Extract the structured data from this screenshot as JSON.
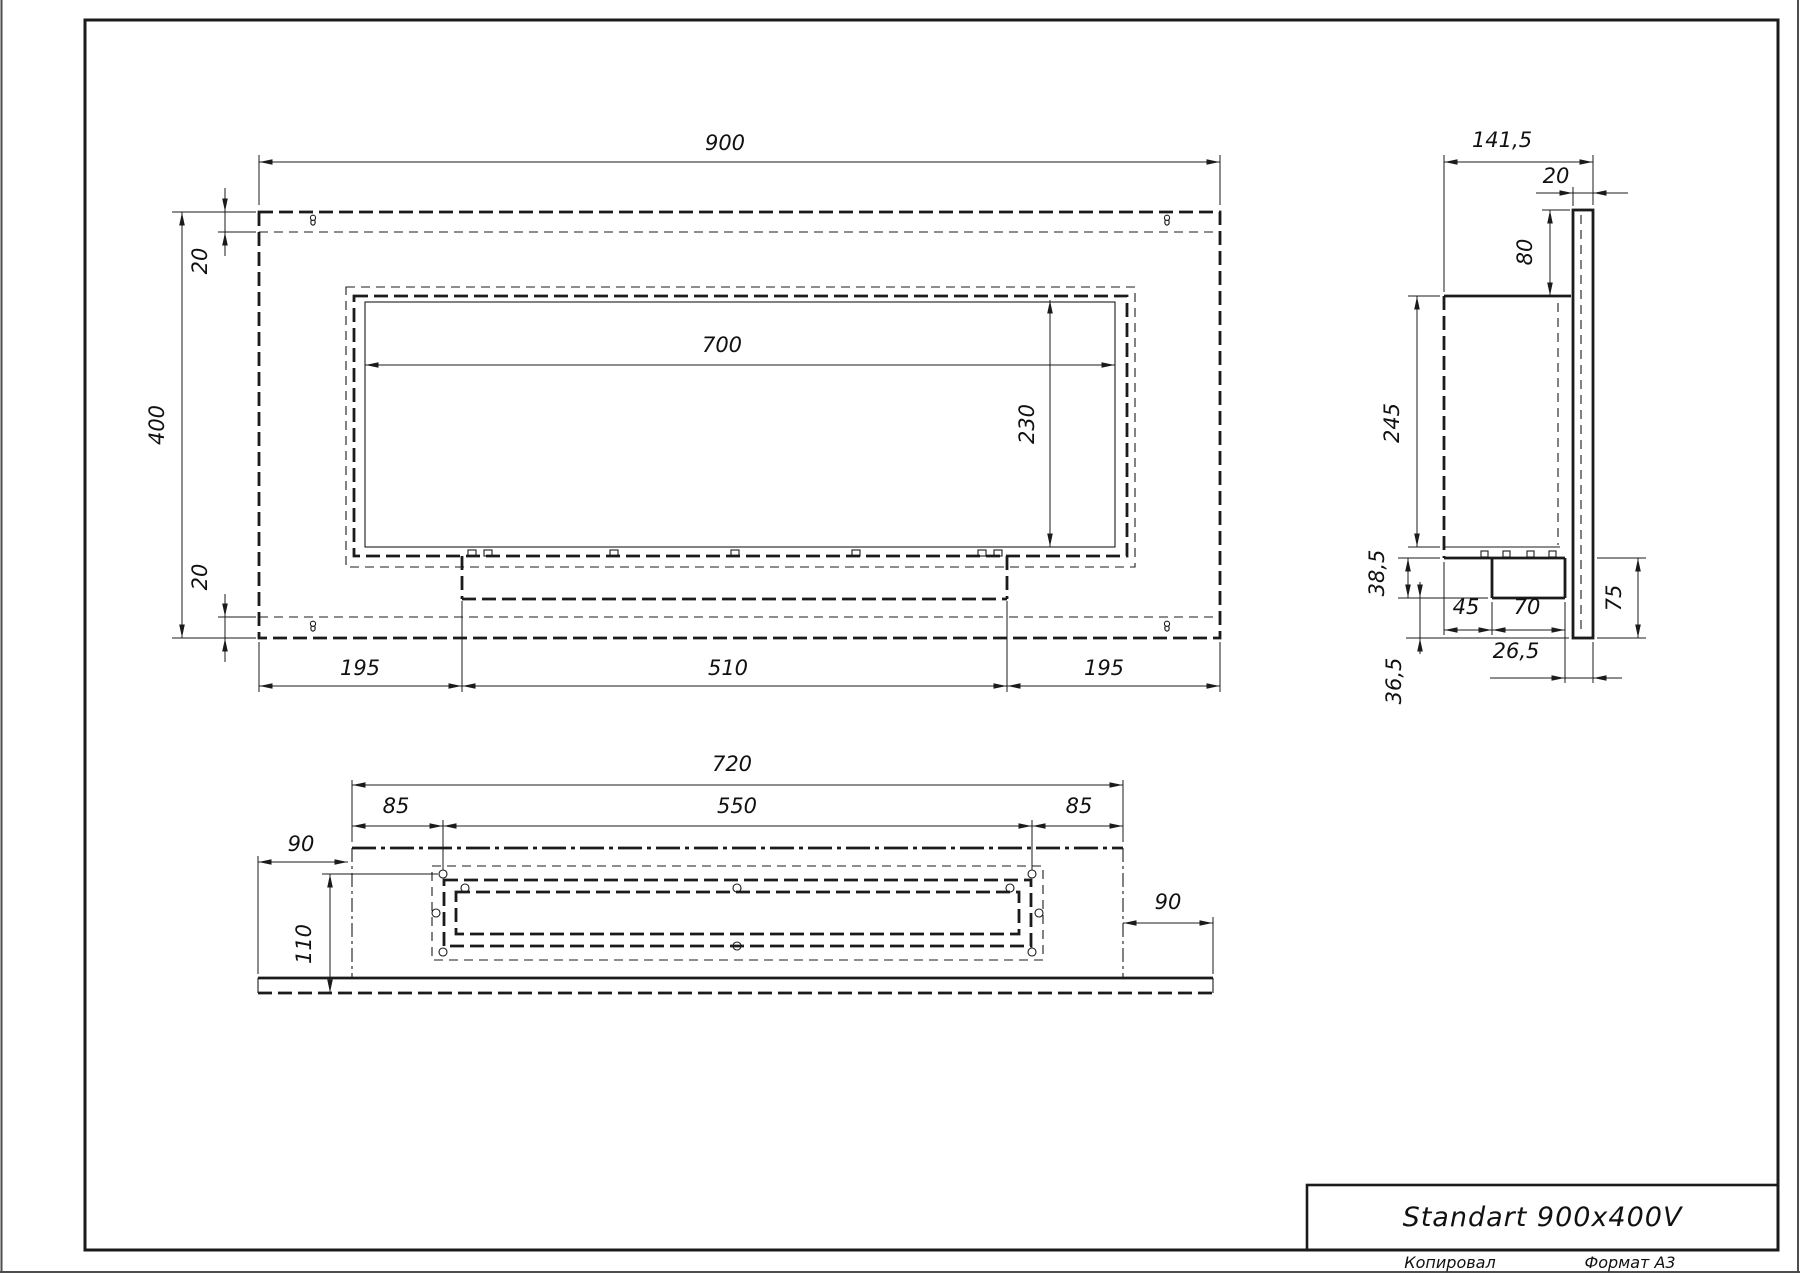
{
  "title_block": {
    "title": "Standart 900x400V",
    "copied_label": "Копировал",
    "format_label": "Формат A3"
  },
  "views": {
    "front": {
      "label": "front-view",
      "dimensions": [
        {
          "id": "front-width-900",
          "text": "900",
          "x": 725,
          "y": 150,
          "rot": 0
        },
        {
          "id": "front-offset-20-top",
          "text": "20",
          "x": 207,
          "y": 261,
          "rot": -90
        },
        {
          "id": "front-height-400",
          "text": "400",
          "x": 164,
          "y": 425,
          "rot": -90
        },
        {
          "id": "front-offset-20-bottom",
          "text": "20",
          "x": 207,
          "y": 577,
          "rot": -90
        },
        {
          "id": "front-window-width-700",
          "text": "700",
          "x": 722,
          "y": 352,
          "rot": 0
        },
        {
          "id": "front-window-height-230",
          "text": "230",
          "x": 1034,
          "y": 424,
          "rot": -90
        },
        {
          "id": "front-left-195",
          "text": "195",
          "x": 360,
          "y": 675,
          "rot": 0
        },
        {
          "id": "front-center-510",
          "text": "510",
          "x": 728,
          "y": 675,
          "rot": 0
        },
        {
          "id": "front-right-195",
          "text": "195",
          "x": 1104,
          "y": 675,
          "rot": 0
        }
      ]
    },
    "side": {
      "label": "side-view",
      "dimensions": [
        {
          "id": "side-depth-141-5",
          "text": "141,5",
          "x": 1502,
          "y": 147,
          "rot": 0
        },
        {
          "id": "side-panel-20",
          "text": "20",
          "x": 1556,
          "y": 183,
          "rot": 0
        },
        {
          "id": "side-top-80",
          "text": "80",
          "x": 1532,
          "y": 252,
          "rot": -90
        },
        {
          "id": "side-body-245",
          "text": "245",
          "x": 1399,
          "y": 423,
          "rot": -90
        },
        {
          "id": "side-38-5",
          "text": "38,5",
          "x": 1384,
          "y": 573,
          "rot": -90
        },
        {
          "id": "side-45",
          "text": "45",
          "x": 1466,
          "y": 614,
          "rot": 0
        },
        {
          "id": "side-70",
          "text": "70",
          "x": 1527,
          "y": 614,
          "rot": 0
        },
        {
          "id": "side-75",
          "text": "75",
          "x": 1621,
          "y": 598,
          "rot": -90
        },
        {
          "id": "side-26-5",
          "text": "26,5",
          "x": 1516,
          "y": 658,
          "rot": 0
        },
        {
          "id": "side-36-5",
          "text": "36,5",
          "x": 1401,
          "y": 681,
          "rot": -90
        }
      ]
    },
    "bottom": {
      "label": "bottom-view",
      "dimensions": [
        {
          "id": "bottom-width-720",
          "text": "720",
          "x": 732,
          "y": 771,
          "rot": 0
        },
        {
          "id": "bottom-85-left",
          "text": "85",
          "x": 396,
          "y": 813,
          "rot": 0
        },
        {
          "id": "bottom-550",
          "text": "550",
          "x": 737,
          "y": 813,
          "rot": 0
        },
        {
          "id": "bottom-85-right",
          "text": "85",
          "x": 1079,
          "y": 813,
          "rot": 0
        },
        {
          "id": "bottom-90-left",
          "text": "90",
          "x": 301,
          "y": 851,
          "rot": 0
        },
        {
          "id": "bottom-depth-110",
          "text": "110",
          "x": 311,
          "y": 944,
          "rot": -90
        },
        {
          "id": "bottom-90-right",
          "text": "90",
          "x": 1168,
          "y": 909,
          "rot": 0
        }
      ]
    }
  }
}
